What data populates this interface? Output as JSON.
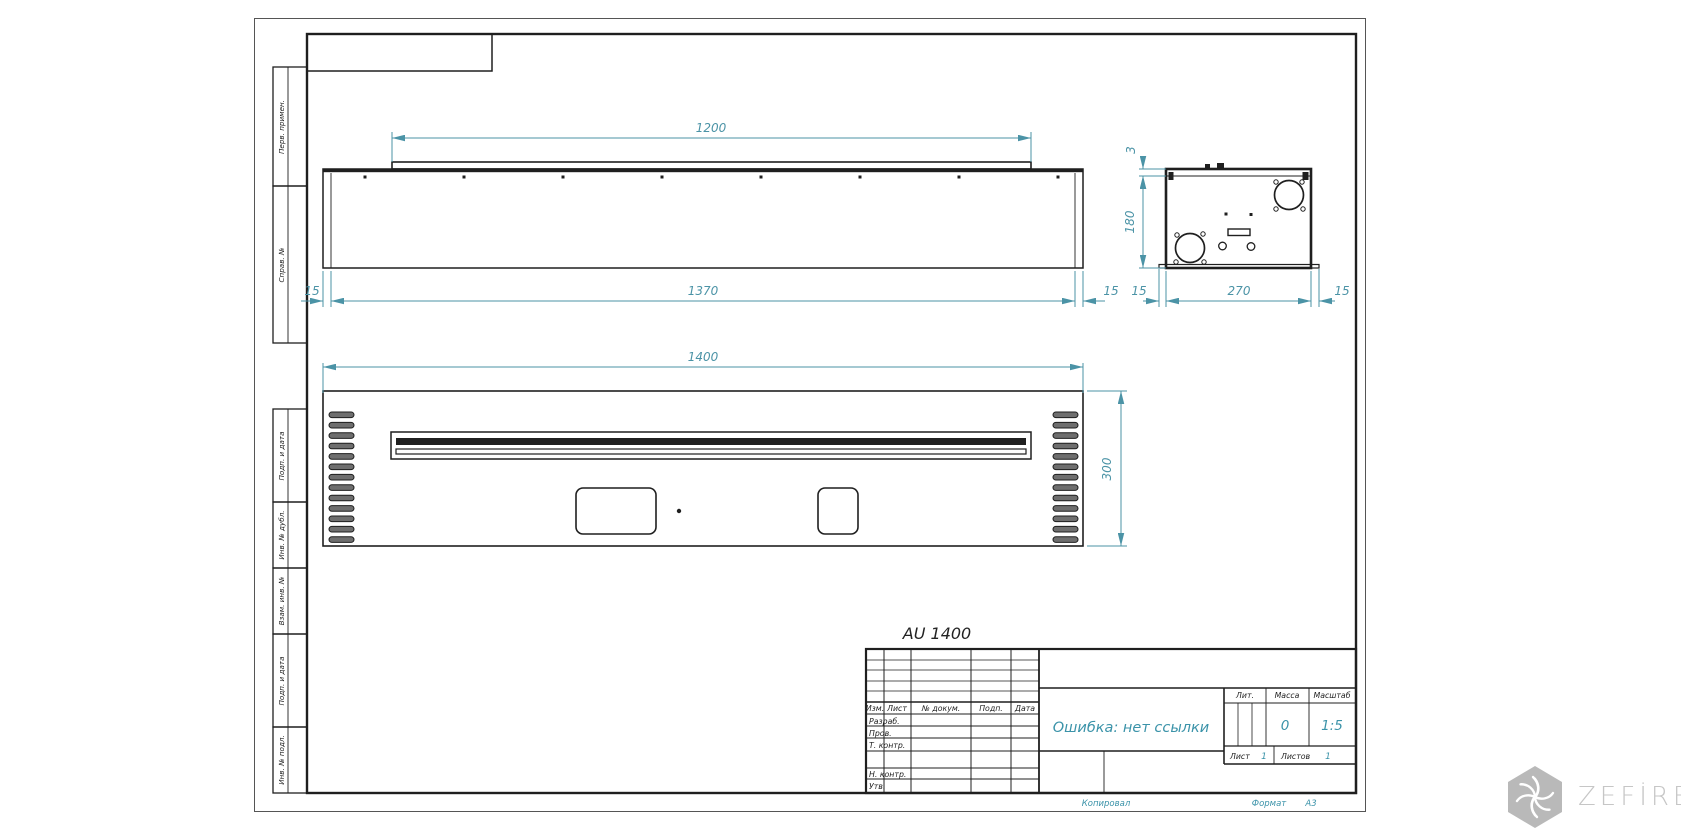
{
  "drawing_title": "AU 1400",
  "views": {
    "top": {
      "dims": {
        "flange": "1200",
        "body": "1370",
        "margin_left": "15",
        "margin_right": "15"
      }
    },
    "side": {
      "dims": {
        "deck": "3",
        "height": "180",
        "depth": "270",
        "margin_left": "15",
        "margin_right": "15"
      }
    },
    "front": {
      "dims": {
        "width": "1400",
        "height": "300"
      }
    }
  },
  "margin_strip": {
    "cells": [
      "Перв. примен.",
      "Справ. №",
      "Подп. и дата",
      "Инв. № дубл.",
      "Взам. инв. №",
      "Подп. и дата",
      "Инв. № подл."
    ]
  },
  "title_block": {
    "header_cols": [
      "Изм.",
      "Лист",
      "№ докум.",
      "Подп.",
      "Дата"
    ],
    "role_rows": [
      "Разраб.",
      "Пров.",
      "Т. контр.",
      "Н. контр.",
      "Утв."
    ],
    "doc_name": "Ошибка: нет ссылки",
    "lit_label": "Лит.",
    "mass_label": "Масса",
    "scale_label": "Масштаб",
    "mass_value": "0",
    "scale_value": "1:5",
    "sheet_label": "Лист",
    "sheet_value": "1",
    "sheets_label": "Листов",
    "sheets_value": "1"
  },
  "footer": {
    "copied_label": "Копировал",
    "format_label": "Формат",
    "format_value": "А3"
  },
  "watermark": {
    "text": "ZEFİRE"
  },
  "colors": {
    "line": "#1f1f1f",
    "dimension": "#4b93a6",
    "teal_text": "#3b93a9",
    "watermark": "#c6c6c6"
  }
}
